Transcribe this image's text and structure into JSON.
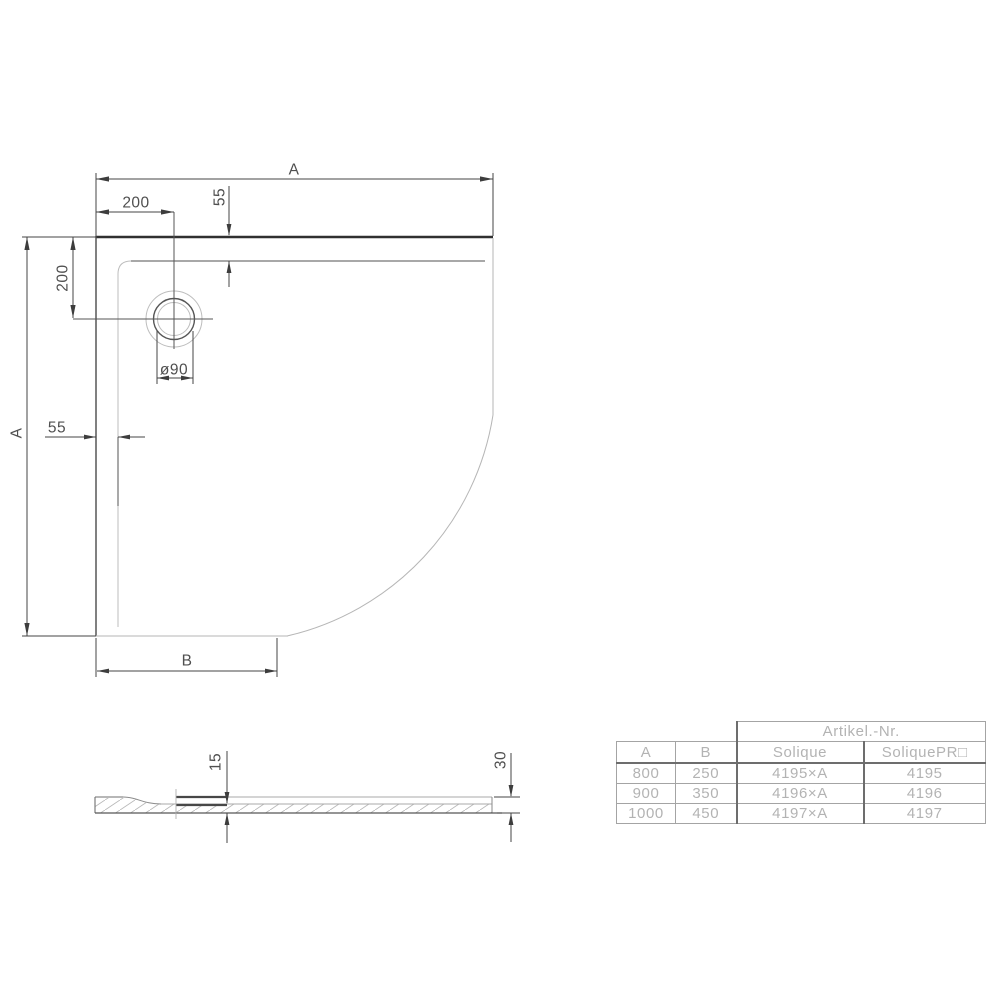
{
  "drawing": {
    "dims": {
      "a_top": "A",
      "w200_top": "200",
      "h55_top": "55",
      "h200_left": "200",
      "a_left": "A",
      "w55_left": "55",
      "drain": "ø90",
      "b_bottom": "B",
      "t15": "15",
      "t30": "30"
    }
  },
  "table": {
    "group_header": "Artikel.-Nr.",
    "columns": [
      "A",
      "B",
      "Solique",
      "SoliquePR□"
    ],
    "rows": [
      [
        "800",
        "250",
        "4195×A",
        "4195"
      ],
      [
        "900",
        "350",
        "4196×A",
        "4196"
      ],
      [
        "1000",
        "450",
        "4197×A",
        "4197"
      ]
    ]
  },
  "colors": {
    "background": "#ffffff",
    "line_dark": "#454545",
    "line_thick_edge": "#303030",
    "line_light": "#b6b6b6",
    "hatch": "#b8b8b8",
    "table_line": "#a4a4a4",
    "table_line_bold": "#6d6d6d",
    "table_text": "#b3b3b3",
    "dim_text": "#4f4f4f"
  }
}
